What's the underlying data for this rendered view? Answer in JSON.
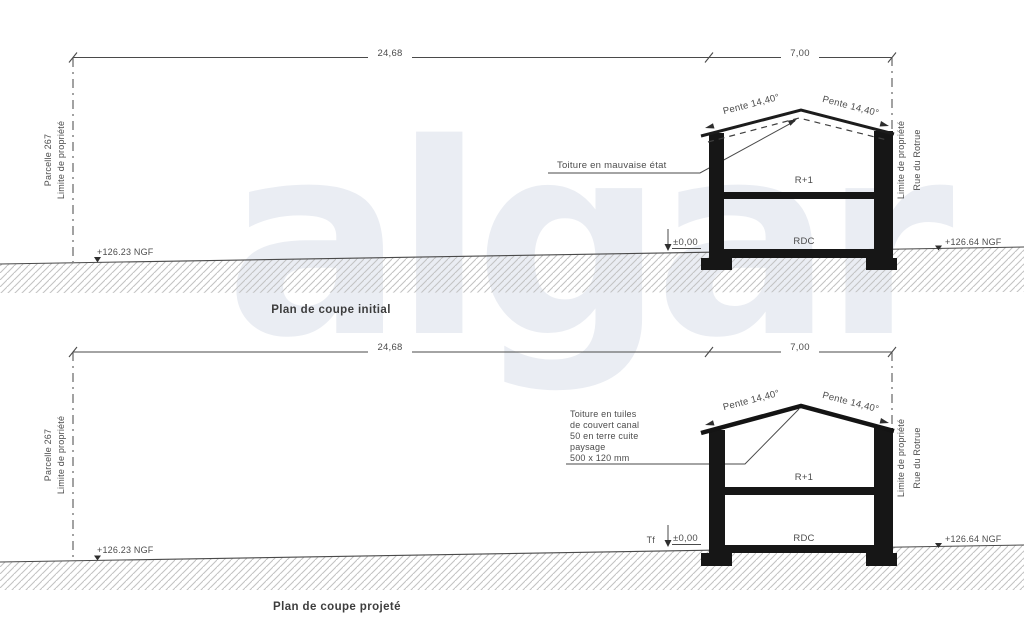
{
  "watermark": "algar",
  "colors": {
    "line": "#4a4a4a",
    "building": "#161616",
    "hatch_stroke": "#c3c3c3",
    "watermark": "#eaedf3",
    "text": "#4c4c4c"
  },
  "sections": [
    {
      "caption": "Plan de coupe initial",
      "dim_main": "24,68",
      "dim_street": "7,00",
      "boundary_left": [
        "Parcelle 267",
        "Limite de propriété"
      ],
      "boundary_right": [
        "Limite de propriété",
        "Rue du Rotrue"
      ],
      "ngf_left": "+126.23 NGF",
      "ngf_right": "+126.64 NGF",
      "level_zero": "±0,00",
      "slope_left": "Pente 14,40°",
      "slope_right": "Pente 14,40°",
      "floor_upper": "R+1",
      "floor_ground": "RDC",
      "roof_note": [
        "Toiture en mauvaise état"
      ]
    },
    {
      "caption": "Plan de coupe projeté",
      "dim_main": "24,68",
      "dim_street": "7,00",
      "boundary_left": [
        "Parcelle 267",
        "Limite de propriété"
      ],
      "boundary_right": [
        "Limite de propriété",
        "Rue du Rotrue"
      ],
      "ngf_left": "+126.23 NGF",
      "ngf_right": "+126.64 NGF",
      "level_zero": "±0,00",
      "tf_label": "Tf",
      "slope_left": "Pente 14,40°",
      "slope_right": "Pente 14,40°",
      "floor_upper": "R+1",
      "floor_ground": "RDC",
      "roof_note": [
        "Toiture en tuiles",
        "de couvert canal",
        "50 en terre cuite",
        "paysage",
        "500 x 120 mm"
      ]
    }
  ]
}
